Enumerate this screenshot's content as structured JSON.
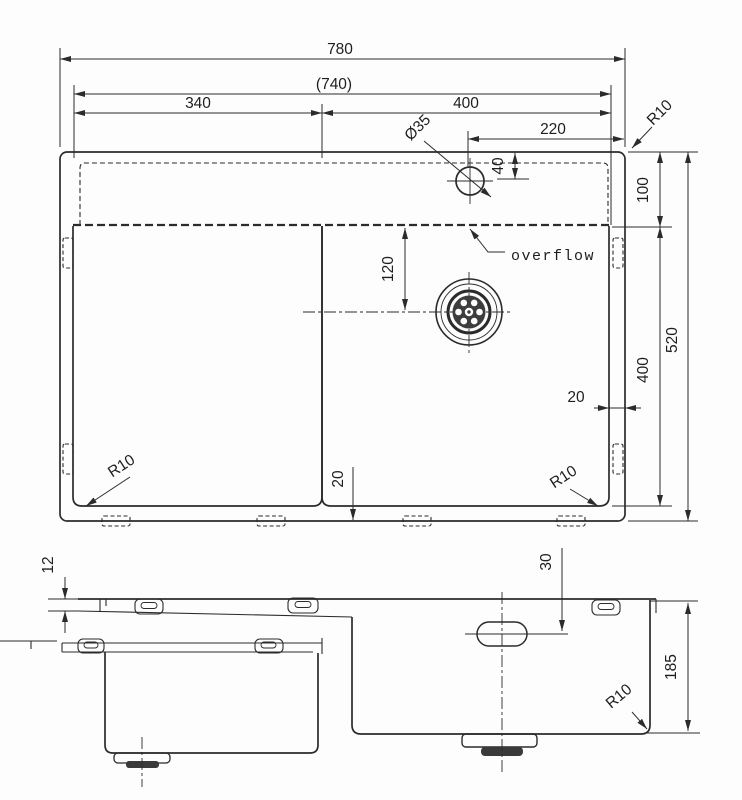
{
  "title": "sink-technical-drawing",
  "top": {
    "overall_width": "780",
    "inner_width": "(740)",
    "left_bowl_width": "340",
    "right_bowl_width": "400",
    "faucet_offset": "220",
    "faucet_hole_dia": "Ø35",
    "faucet_hole_offset": "40",
    "ledge_height": "100",
    "overall_depth": "520",
    "bowl_depth": "400",
    "drain_offset": "120",
    "rim_right": "20",
    "rim_bottom": "20",
    "corner_radius_top_right": "R10",
    "corner_radius_bottom_left": "R10",
    "corner_radius_bottom_right": "R10",
    "overflow_label": "overflow"
  },
  "side": {
    "rim_thickness": "12",
    "hole_offset": "30",
    "bowl_depth": "185",
    "corner_radius": "R10"
  }
}
